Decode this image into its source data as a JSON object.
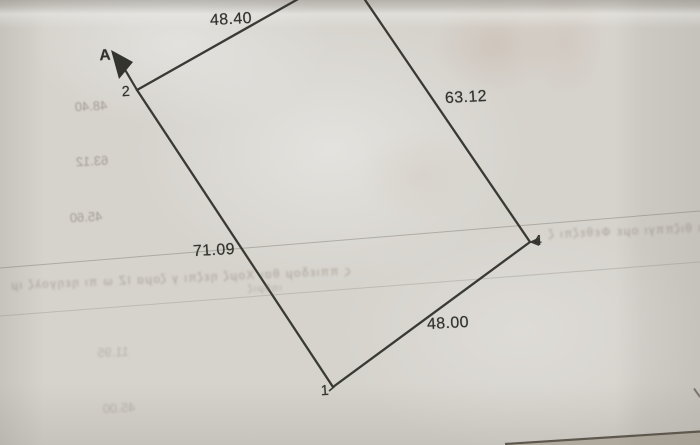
{
  "photo": {
    "description": "photograph of a hand-drawn land parcel survey sketch on creased lined paper",
    "parcel": {
      "side_lengths": {
        "top": "48.40",
        "right": "63.12",
        "left": "71.09",
        "bottom": "48.00"
      },
      "vertex_labels": {
        "v1": "1",
        "v2": "2",
        "v4": "4"
      },
      "direction_label": "A"
    },
    "bleedthrough": {
      "numbers": {
        "n1": "48.40",
        "n2": "63.12",
        "n3": "45.60",
        "n4": "11.95",
        "n5": "45.00"
      },
      "band_left": "ς ππιεδομ θαι Χομζ ηεζπι γ ζομα ΙΖ ω πι ηεηγολζ ιμ",
      "band_right": "ι θιζππγι ομε Φεθεζπι ζ",
      "band_small": "ιηθμιζ"
    }
  }
}
